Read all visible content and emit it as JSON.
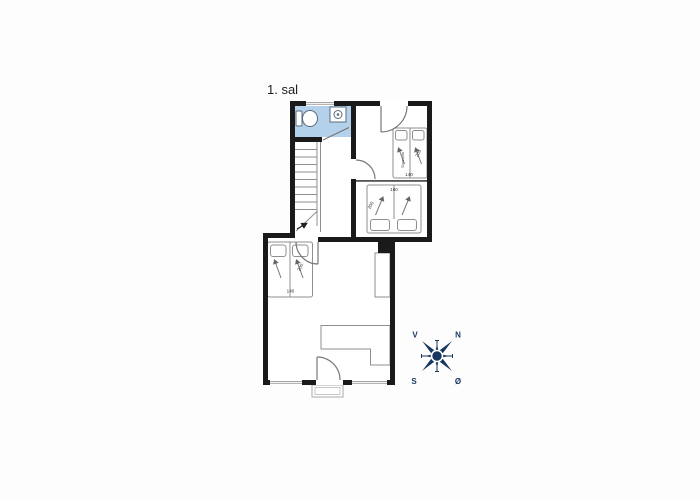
{
  "title": "1. sal",
  "compass": {
    "west": "V",
    "north": "N",
    "south": "S",
    "east": "Ø"
  },
  "bed_labels": {
    "right_room": {
      "vertical": "Sovesofa",
      "length": "200",
      "width": "140"
    },
    "middle_room": {
      "width": "160",
      "length": "200"
    },
    "left_area": {
      "length": "200",
      "width": "140"
    }
  },
  "colors": {
    "wall": "#1a1a1a",
    "bathroom": "#b3d1ea",
    "furniture_line": "#8f8f8f",
    "compass": "#17365f"
  }
}
